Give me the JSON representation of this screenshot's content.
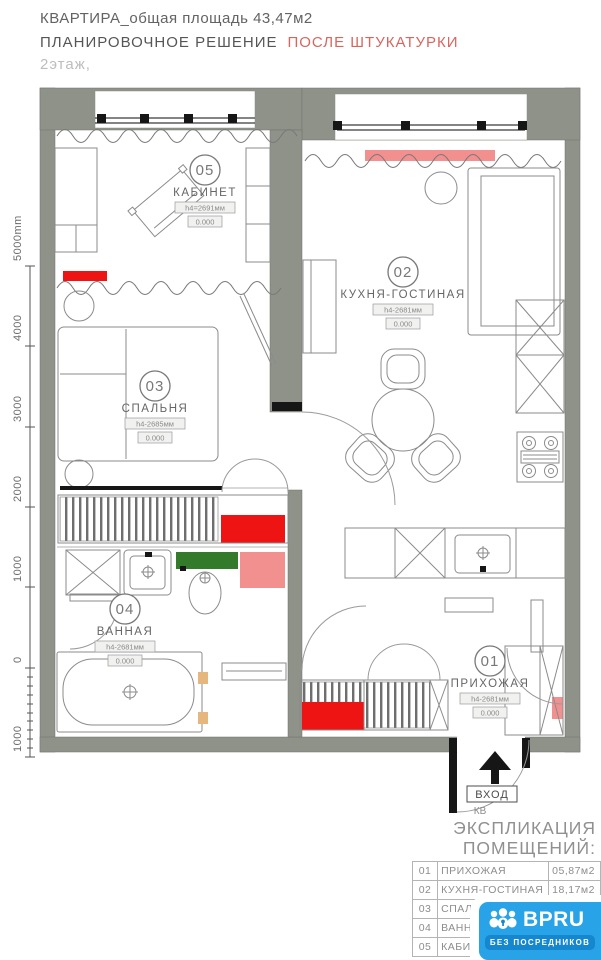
{
  "header": {
    "title": "КВАРТИРА_общая площадь 43,47м2",
    "subtitle": "ПЛАНИРОВОЧНОЕ РЕШЕНИЕ",
    "subtitle_accent": "ПОСЛЕ ШТУКАТУРКИ",
    "floor": "2этаж,"
  },
  "ruler": {
    "ticks": [
      "5000mm",
      "4000",
      "3000",
      "2000",
      "1000",
      "0",
      "1000"
    ]
  },
  "rooms": [
    {
      "number": "05",
      "name": "КАБИНЕТ",
      "height": "h4=2691мм",
      "level": "0.000"
    },
    {
      "number": "02",
      "name": "КУХНЯ-ГОСТИНАЯ",
      "height": "h4-2681мм",
      "level": "0.000"
    },
    {
      "number": "03",
      "name": "СПАЛЬНЯ",
      "height": "h4-2685мм",
      "level": "0.000"
    },
    {
      "number": "04",
      "name": "ВАННАЯ",
      "height": "h4-2681мм",
      "level": "0.000"
    },
    {
      "number": "01",
      "name": "ПРИХОЖАЯ",
      "height": "h4-2681мм",
      "level": "0.000"
    }
  ],
  "entrance": {
    "label": "ВХОД",
    "sublabel": "КВ"
  },
  "legend": {
    "title_line1": "ЭКСПЛИКАЦИЯ",
    "title_line2": "ПОМЕЩЕНИЙ:",
    "rows": [
      {
        "num": "01",
        "name": "ПРИХОЖАЯ",
        "area": "05,87м2"
      },
      {
        "num": "02",
        "name": "КУХНЯ-ГОСТИНАЯ",
        "area": "18,17м2"
      },
      {
        "num": "03",
        "name": "СПАЛЬНЯ",
        "area": ""
      },
      {
        "num": "04",
        "name": "ВАННАЯ",
        "area": ""
      },
      {
        "num": "05",
        "name": "КАБИНЕТ",
        "area": ""
      }
    ]
  },
  "logo": {
    "brand": "BPRU",
    "tagline": "БЕЗ ПОСРЕДНИКОВ"
  },
  "colors": {
    "wall": "#8e9289",
    "accent_red": "#ee1414",
    "accent_salmon": "#f29090",
    "accent_green": "#337a2b",
    "title_accent": "#d9655f",
    "logo_blue": "#29a3e8",
    "logo_blue_dark": "#1487ce"
  }
}
